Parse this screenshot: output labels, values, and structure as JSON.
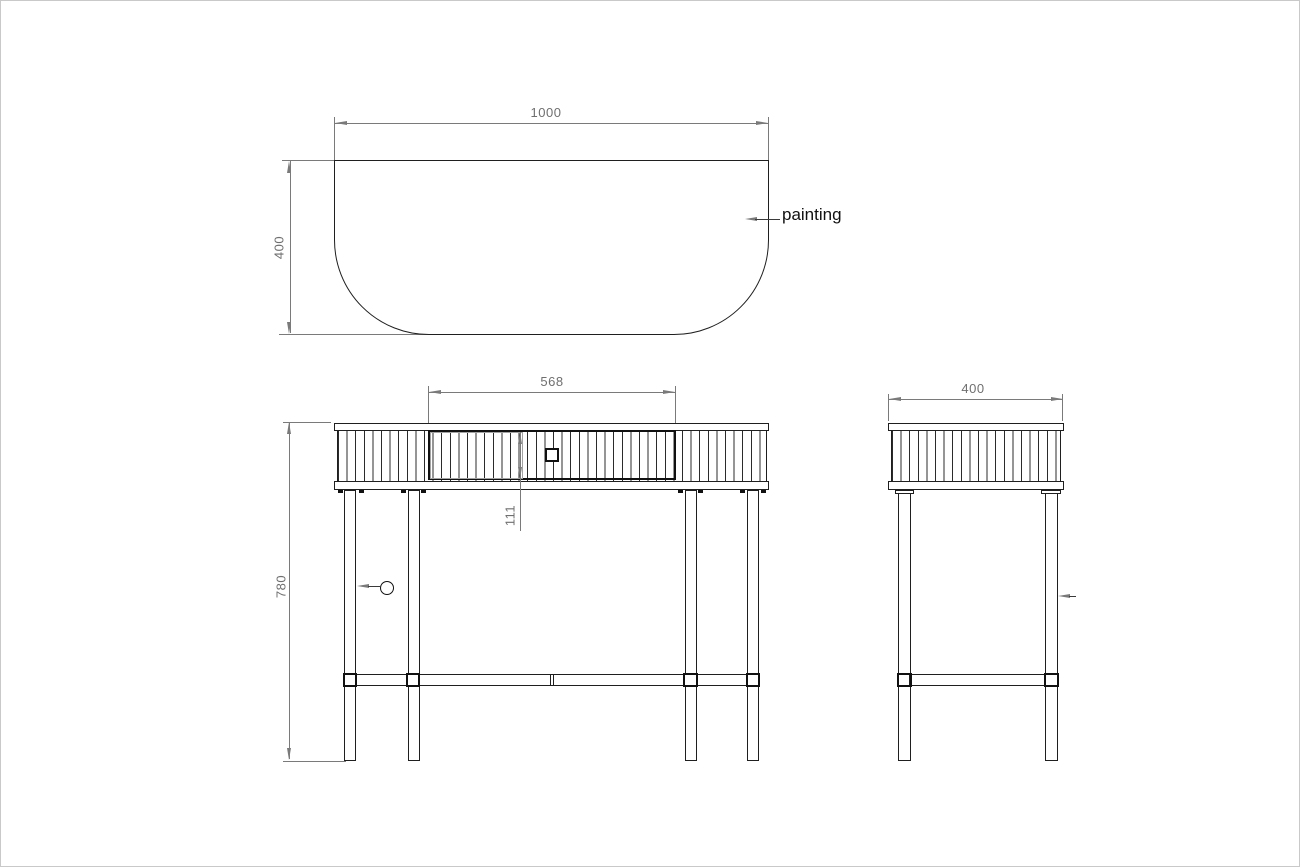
{
  "drawing": {
    "top": {
      "width": "1000",
      "depth": "400",
      "annotation": "painting"
    },
    "front": {
      "drawer_width": "568",
      "drawer_height": "111",
      "height": "780"
    },
    "side": {
      "depth": "400"
    }
  },
  "colors": {
    "geometry_line": "#1f1f1f",
    "dimension": "#6f6f6f",
    "background": "#ffffff"
  }
}
